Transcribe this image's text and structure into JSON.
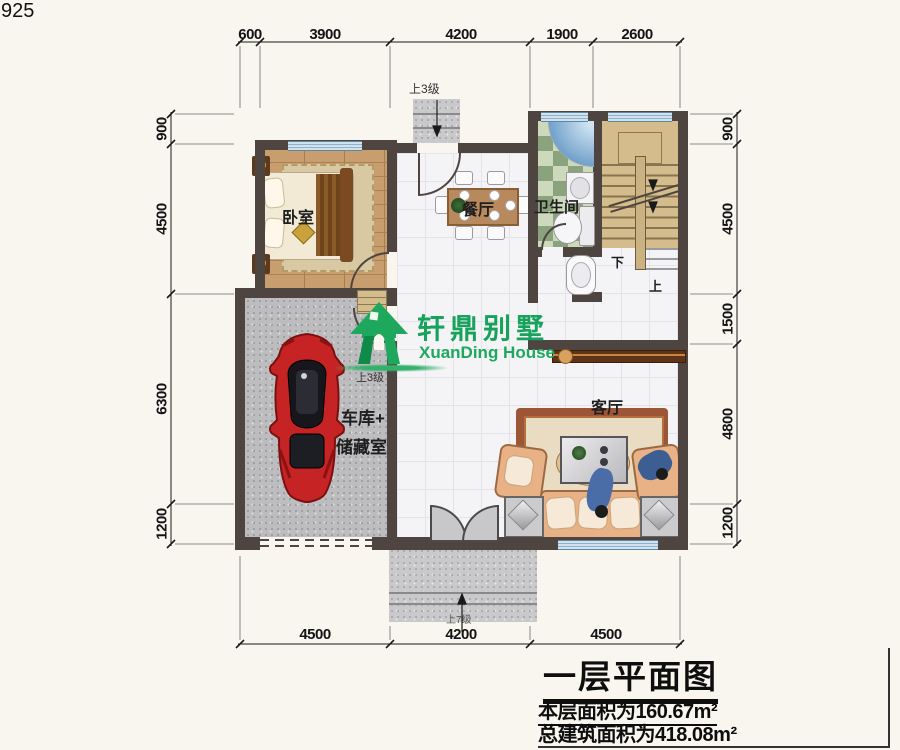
{
  "meta": {
    "corner_code": "925"
  },
  "dimensions": {
    "top": [
      "600",
      "3900",
      "4200",
      "1900",
      "2600"
    ],
    "bottom": [
      "4500",
      "4200",
      "4500"
    ],
    "left": [
      "900",
      "4500",
      "6300",
      "1200"
    ],
    "right": [
      "900",
      "4500",
      "1500",
      "4800",
      "1200"
    ]
  },
  "rooms": {
    "bedroom": "卧室",
    "dining": "餐厅",
    "bathroom": "卫生间",
    "garage_line1": "车库+",
    "garage_line2": "储藏室",
    "living": "客厅"
  },
  "stairs": {
    "up": "上",
    "down": "下"
  },
  "steps": {
    "top_entry": "上3级",
    "garage": "上3级",
    "front_entry": "上7级"
  },
  "logo": {
    "cn": "轩鼎别墅",
    "en": "XuanDing House",
    "color": "#1ea35e"
  },
  "title_block": {
    "title": "一层平面图",
    "floor_area": "本层面积为160.67m²",
    "total_area": "总建筑面积为418.08m²"
  },
  "colors": {
    "wall": "#4e4540",
    "window": "#cfe2ee",
    "car": "#c32222",
    "stair": "#d4bc8c",
    "bath_tile_dark": "#8ba37d",
    "bath_tile_light": "#ccd9bd"
  }
}
